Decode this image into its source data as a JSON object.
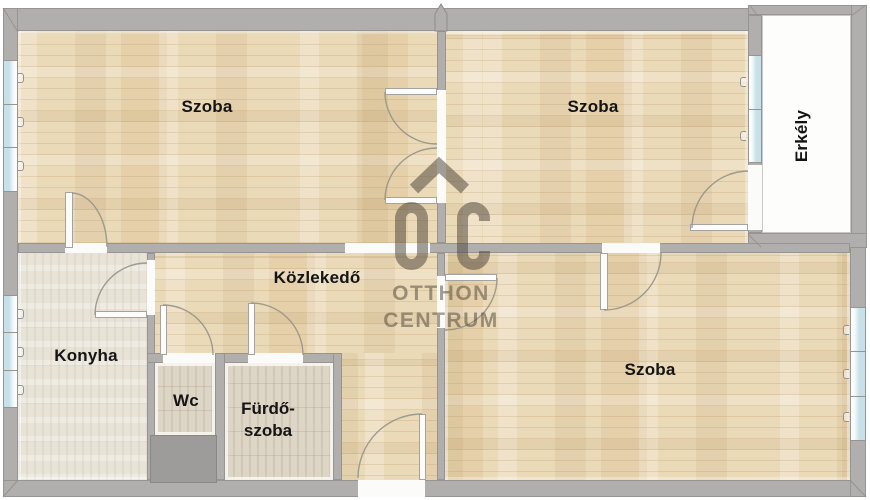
{
  "rooms": {
    "top_left_szoba": "Szoba",
    "top_right_szoba": "Szoba",
    "bottom_szoba": "Szoba",
    "kitchen": "Konyha",
    "hallway": "Közlekedő",
    "wc": "Wc",
    "bathroom_line1": "Fürdő-",
    "bathroom_line2": "szoba",
    "balcony": "Erkély"
  },
  "watermark": {
    "monogram": "OC",
    "brand_line1": "OTTHON",
    "brand_line2": "CENTRUM"
  },
  "colors": {
    "wall": "#b1afad",
    "wood_floor": "#ebdab8",
    "kitchen_floor": "#e8e3d7",
    "bathroom_floor": "#ddd5c5",
    "window_glass": "#c8e0e8",
    "balcony_floor": "#fdfdfc",
    "shaft": "#9d9c9a",
    "label_text": "#141414",
    "watermark": "#4f463d"
  }
}
